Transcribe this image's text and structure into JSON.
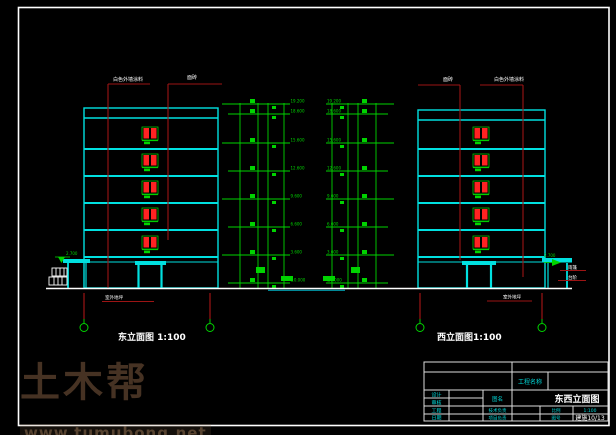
{
  "page": {
    "background": "#000000",
    "frame_color": "#ffffff"
  },
  "colors": {
    "building_outline": "#00e0e0",
    "dimension_green": "#00d400",
    "window_red": "#ff2222",
    "leader_dark_red": "#9c1414",
    "annotation_white": "#ffffff"
  },
  "elevations": {
    "east": {
      "title": "东立面图 1:100",
      "material_label_1": "白色外墙涂料",
      "material_label_2": "面砖",
      "ground_note": "室外地坪"
    },
    "west": {
      "title": "西立面图1:100",
      "material_label_1": "面砖",
      "material_label_2": "白色外墙涂料",
      "porch_note_1": "雨篷",
      "porch_note_2": "台阶",
      "ground_note": "室外地坪"
    },
    "levels": [
      "19.200",
      "18.600",
      "15.600",
      "12.600",
      "9.600",
      "6.600",
      "3.600",
      "±0.000"
    ],
    "porch_level": "2.700"
  },
  "title_block": {
    "project_label": "工程名称",
    "rows": [
      {
        "label": "设计"
      },
      {
        "label": "审核"
      },
      {
        "label": "工程"
      },
      {
        "label": "日期"
      }
    ],
    "drawing_name_label": "图名",
    "drawing_name": "东西立面图",
    "mid_label_1": "技术负责",
    "mid_label_2": "项目负责",
    "scale_label": "比例",
    "scale_value": "1:100",
    "sheet_label": "图号",
    "sheet_value": "建施10/13"
  },
  "watermark": {
    "logo": "土木帮",
    "url": "www.tumubong.net"
  }
}
